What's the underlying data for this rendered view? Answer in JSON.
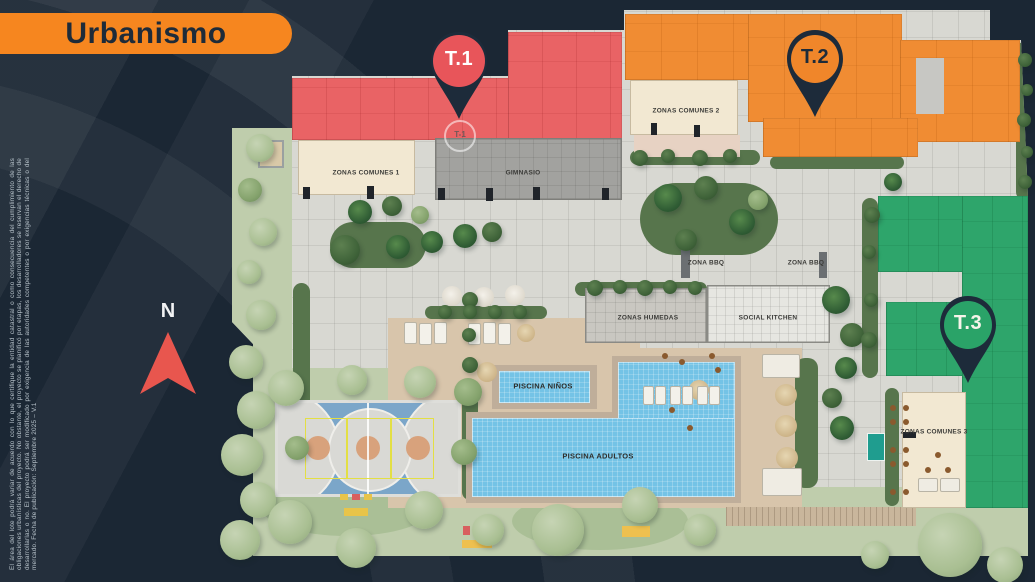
{
  "title": "Urbanismo",
  "disclaimer": "El área del lote podrá variar de acuerdo con lo que certifique la entidad catastral o como consecuencia del cumplimiento de las obligaciones urbanísticas del proyecto. No obstante, el proyecto se planificó por etapas, los desarrolladores se reservan el derecho de desarrollarlas o no. El proyecto podrá ser modificado por exigencia de las autoridades competentes o por exigencias técnicas o del mercado. Fecha de publicación: Septiembre 2025 – V.1",
  "compass": {
    "label": "N"
  },
  "towers": {
    "t1": {
      "label": "T.1",
      "color": "#e8555a"
    },
    "t2": {
      "label": "T.2",
      "color": "#f0862a"
    },
    "t3": {
      "label": "T.3",
      "color": "#2aa368"
    },
    "t1_ground_marker": "T-1"
  },
  "map_labels": {
    "zonas_comunes_1": "ZONAS COMUNES 1",
    "gimnasio": "GIMNASIO",
    "zonas_comunes_2": "ZONAS COMUNES 2",
    "zona_bbq_left": "ZONA BBQ",
    "zona_bbq_right": "ZONA BBQ",
    "zonas_humedas": "ZONAS HUMEDAS",
    "social_kitchen": "SOCIAL KITCHEN",
    "zonas_comunes_3": "ZONAS COMUNES 3",
    "piscina_ninos": "PISCINA NIÑOS",
    "piscina_adultos": "PISCINA ADULTOS"
  },
  "colors": {
    "background_navy": "#1b2734",
    "banner_orange": "#f6861f",
    "pin_body_navy": "#1d2b3a",
    "hardscape_gray": "#d8d8d2",
    "lawn_green": "#bfcdac",
    "pool_blue": "#74c3e6"
  }
}
